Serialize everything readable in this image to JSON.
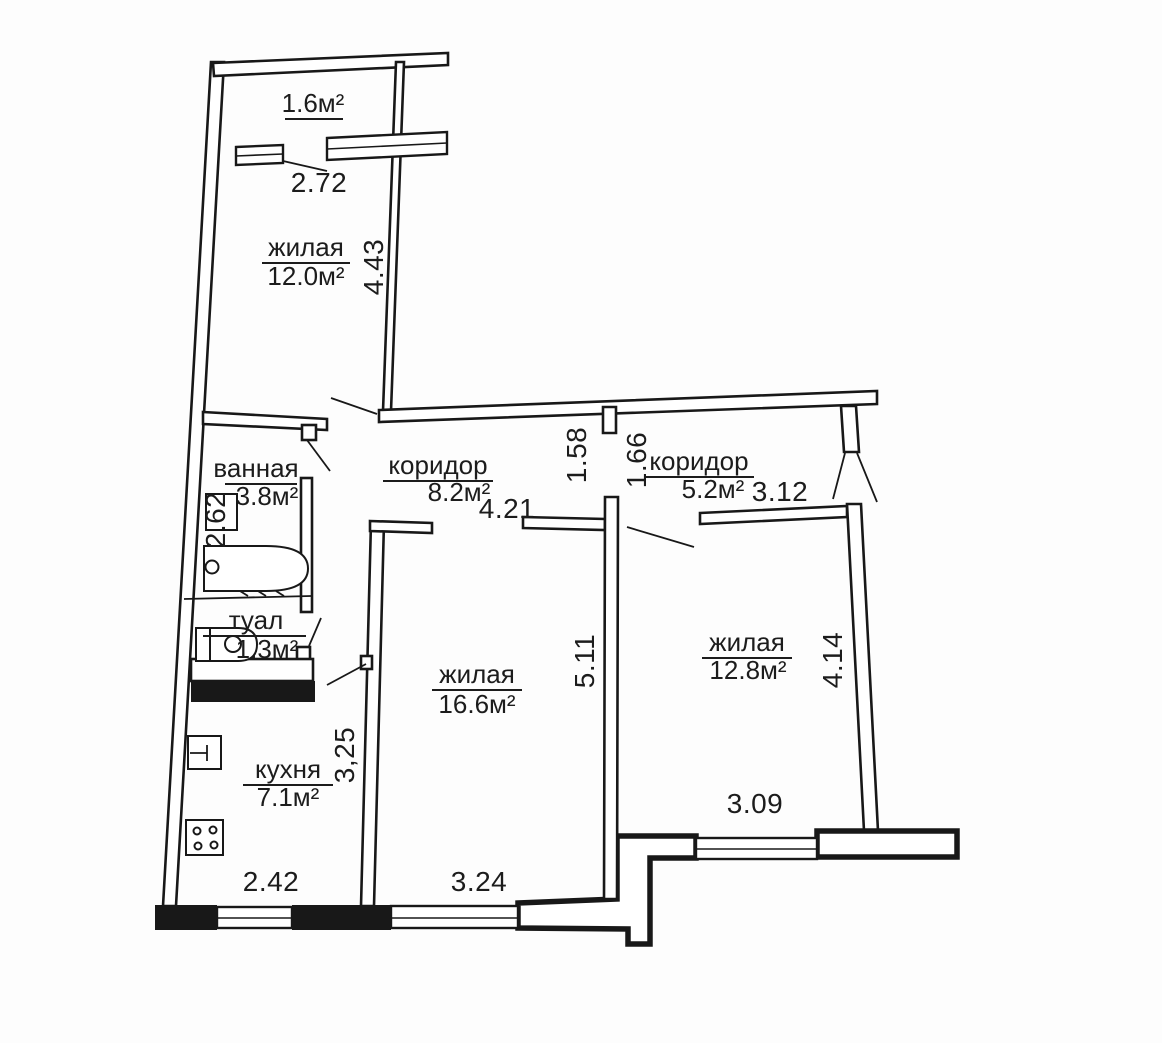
{
  "document": {
    "type": "apartment floor plan",
    "language": "ru"
  },
  "colors": {
    "background": "#fdfdfd",
    "line": "#181818",
    "text": "#1c1c1c"
  },
  "rooms": {
    "balcony": {
      "label": "",
      "area": "1.6м²"
    },
    "living1": {
      "label": "жилая",
      "area": "12.0м²"
    },
    "bath": {
      "label": "ванная",
      "area": "3.8м²"
    },
    "hall1": {
      "label": "коридор",
      "area": "8.2м²"
    },
    "hall2": {
      "label": "коридор",
      "area": "5.2м²"
    },
    "wc": {
      "label": "туал",
      "area": "1.3м²"
    },
    "living2": {
      "label": "жилая",
      "area": "16.6м²"
    },
    "living3": {
      "label": "жилая",
      "area": "12.8м²"
    },
    "kitchen": {
      "label": "кухня",
      "area": "7.1м²"
    }
  },
  "dims": {
    "balcony_width": "2.72",
    "living1_depth": "4.43",
    "bath_depth": "2.62",
    "hall1_length": "4.21",
    "hall1_width": "1.58",
    "hall2_entry": "1.66",
    "hall2_length": "3.12",
    "living2_depth": "5.11",
    "kitchen_depth": "3,25",
    "living3_depth": "4.14",
    "living3_width": "3.09",
    "kitchen_width": "2.42",
    "living2_width": "3.24"
  }
}
